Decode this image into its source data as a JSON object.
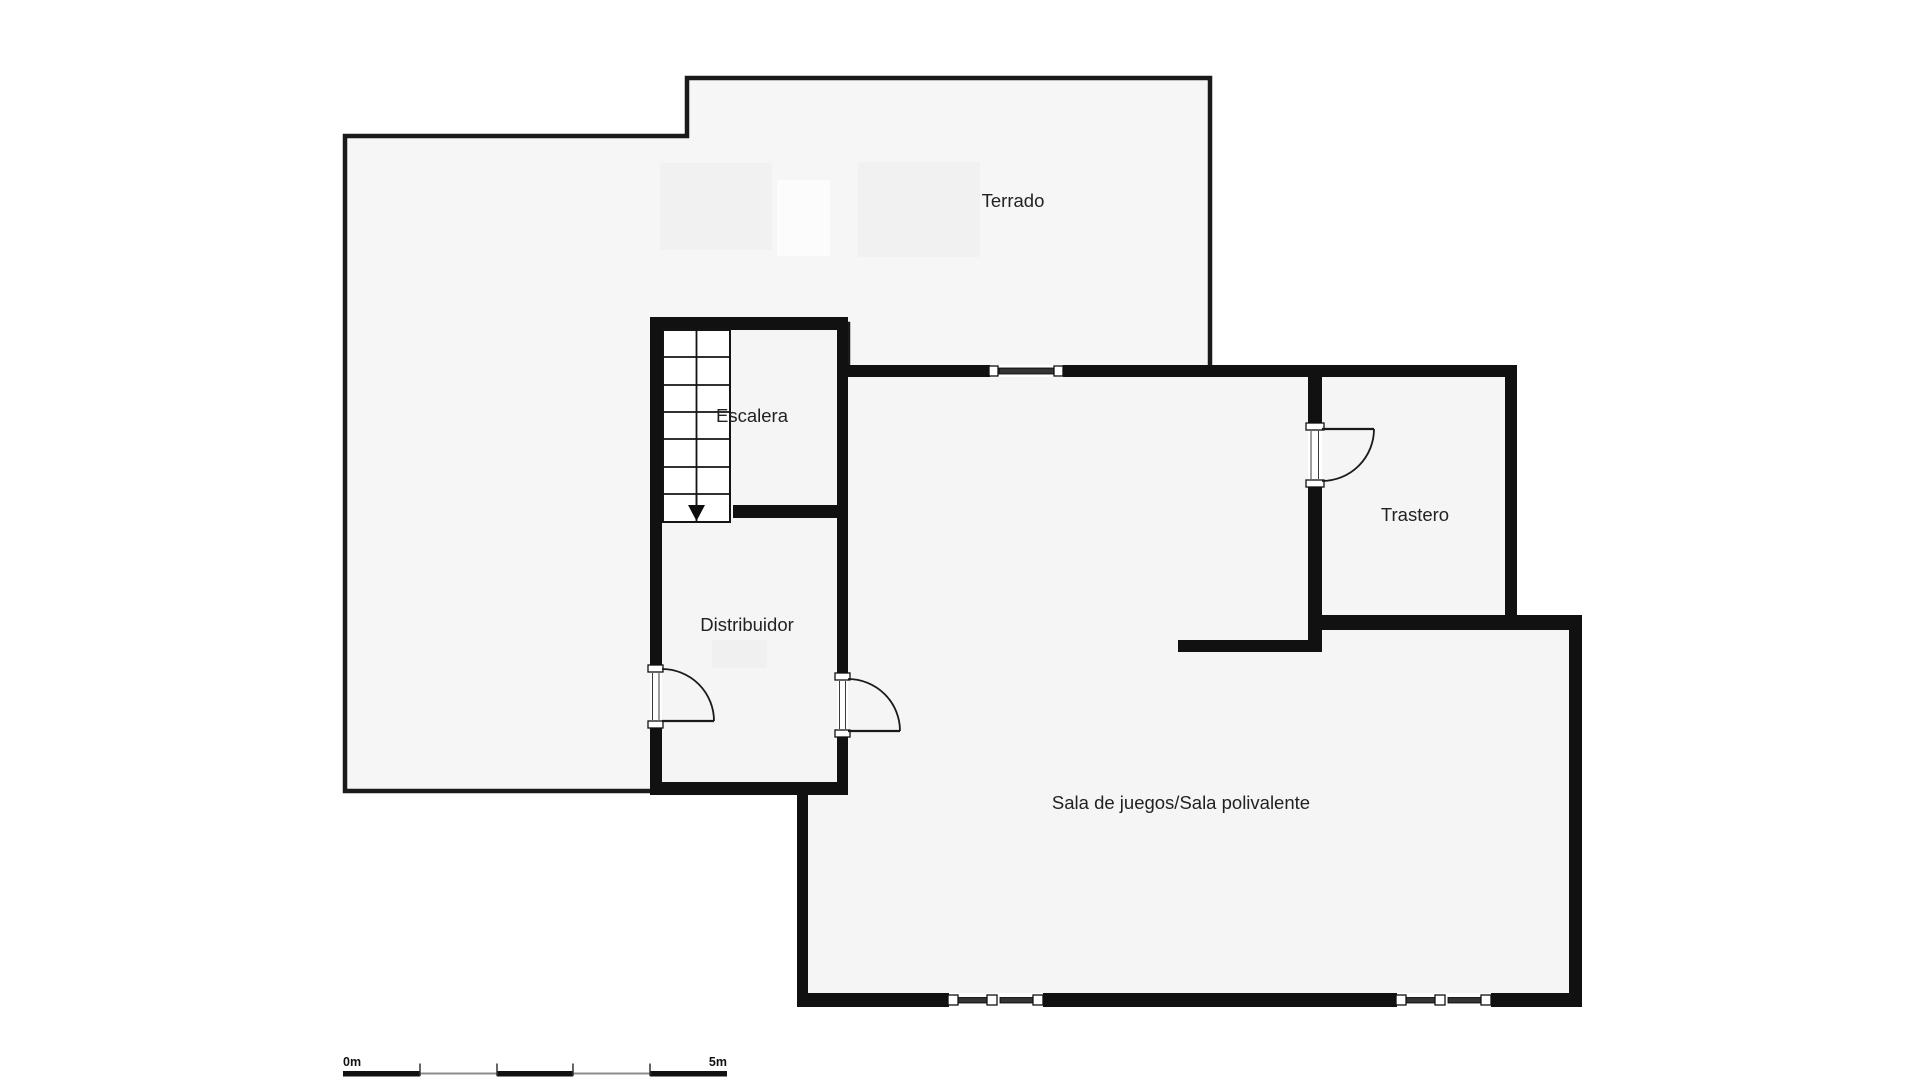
{
  "plan": {
    "rooms": [
      {
        "id": "terrado",
        "label": "Terrado"
      },
      {
        "id": "escalera",
        "label": "Escalera"
      },
      {
        "id": "distribuidor",
        "label": "Distribuidor"
      },
      {
        "id": "trastero",
        "label": "Trastero"
      },
      {
        "id": "sala_de_juegos",
        "label": "Sala de juegos/Sala polivalente"
      }
    ],
    "scale_bar": {
      "start_label": "0m",
      "end_label": "5m"
    },
    "colors": {
      "wall": "#111111",
      "terrace_outline": "#1a1a1a",
      "room_fill": "#f5f5f5",
      "terrace_fill": "#f6f6f6",
      "background": "#ffffff"
    }
  }
}
